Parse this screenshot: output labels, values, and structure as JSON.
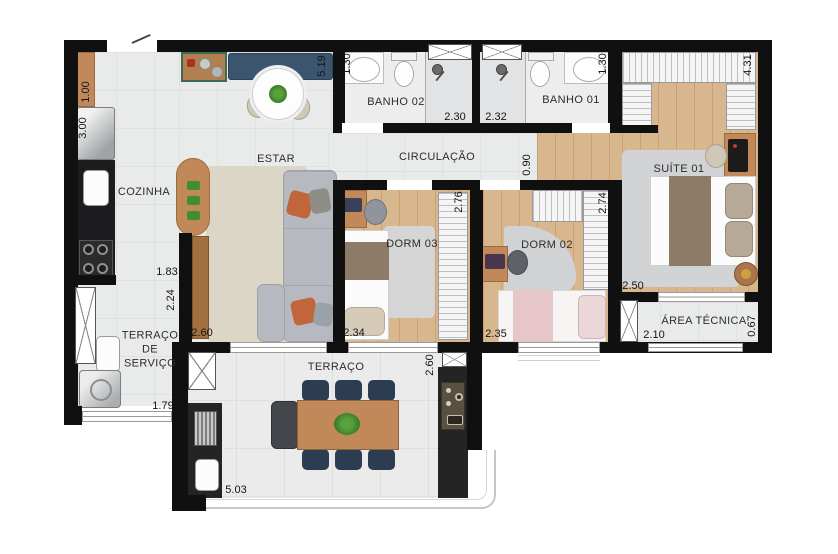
{
  "plan": {
    "rooms": {
      "cozinha": "COZINHA",
      "estar": "ESTAR",
      "circulacao": "CIRCULAÇÃO",
      "banho02": "BANHO 02",
      "banho01": "BANHO 01",
      "suite01": "SUÍTE 01",
      "dorm03": "DORM 03",
      "dorm02": "DORM 02",
      "area_tecnica": "ÁREA TÉCNICA",
      "terraco_servico": "TERRAÇO DE SERVIÇO",
      "terraco": "TERRAÇO"
    },
    "dimensions": {
      "cozinha_counter": "1.00",
      "cozinha_side": "3.00",
      "estar_length": "5.19",
      "banho02_width": "1.30",
      "banho02_length": "2.30",
      "banho01_length": "2.32",
      "banho01_width": "1.30",
      "suite_length": "4.31",
      "circulacao_width": "0.90",
      "dorm03_depth": "2.76",
      "dorm02_depth": "2.74",
      "suite_width": "2.50",
      "cozinha_width": "1.83",
      "servico_depth": "2.24",
      "estar_width": "2.60",
      "dorm03_width": "2.34",
      "dorm02_width": "2.35",
      "area_tecnica_width": "2.10",
      "area_tecnica_depth": "0.67",
      "servico_width": "1.79",
      "terraco_depth": "2.60",
      "terraco_width": "5.03"
    },
    "colors": {
      "wall": "#101010",
      "wood_floor": "#d9b78e",
      "tile_floor": "#e9eaea",
      "bench_blue": "#3b556e",
      "chair_navy": "#2d3d51",
      "accent_orange": "#c0663a",
      "accent_pink": "#e6c6c9"
    }
  }
}
